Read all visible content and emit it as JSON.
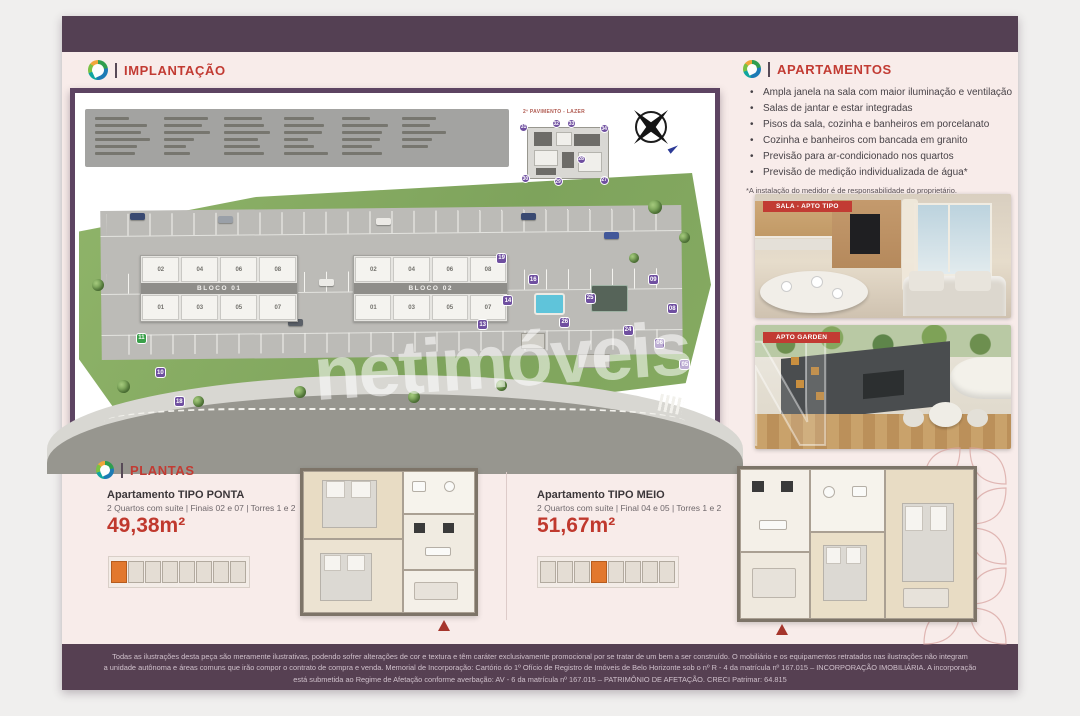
{
  "brand": {
    "watermark_text": "netimóveis",
    "watermark_initial": "N"
  },
  "implantacao": {
    "title": "IMPLANTAÇÃO",
    "inset_label": "2º PAVIMENTO - LAZER",
    "blocks": [
      {
        "name": "BLOCO 01",
        "top_units": [
          "02",
          "04",
          "06",
          "08"
        ],
        "bottom_units": [
          "01",
          "03",
          "05",
          "07"
        ]
      },
      {
        "name": "BLOCO 02",
        "top_units": [
          "02",
          "04",
          "06",
          "08"
        ],
        "bottom_units": [
          "01",
          "03",
          "05",
          "07"
        ]
      }
    ],
    "badges": [
      {
        "n": "11",
        "x": 9,
        "y": 60,
        "v": "green"
      },
      {
        "n": "10",
        "x": 12,
        "y": 73
      },
      {
        "n": "18",
        "x": 15,
        "y": 84
      },
      {
        "n": "19",
        "x": 66,
        "y": 30
      },
      {
        "n": "16",
        "x": 71,
        "y": 38
      },
      {
        "n": "14",
        "x": 67,
        "y": 46
      },
      {
        "n": "13",
        "x": 63,
        "y": 55
      },
      {
        "n": "26",
        "x": 76,
        "y": 54
      },
      {
        "n": "25",
        "x": 80,
        "y": 45
      },
      {
        "n": "24",
        "x": 86,
        "y": 57
      },
      {
        "n": "09",
        "x": 90,
        "y": 38
      },
      {
        "n": "08",
        "x": 93,
        "y": 49
      },
      {
        "n": "06",
        "x": 91,
        "y": 62
      },
      {
        "n": "05",
        "x": 95,
        "y": 70
      }
    ],
    "inset_badges": [
      {
        "n": "31",
        "x": 0,
        "y": 6
      },
      {
        "n": "32",
        "x": 34,
        "y": 0
      },
      {
        "n": "33",
        "x": 50,
        "y": 0
      },
      {
        "n": "34",
        "x": 84,
        "y": 8
      },
      {
        "n": "28",
        "x": 60,
        "y": 54
      },
      {
        "n": "30",
        "x": 2,
        "y": 84
      },
      {
        "n": "29",
        "x": 36,
        "y": 88
      },
      {
        "n": "27",
        "x": 84,
        "y": 86
      }
    ]
  },
  "apartamentos": {
    "title": "APARTAMENTOS",
    "bullets": [
      "Ampla janela na sala com maior iluminação e ventilação",
      "Salas de jantar e estar integradas",
      "Pisos da sala, cozinha e banheiros em porcelanato",
      "Cozinha e banheiros com bancada em granito",
      "Previsão para ar-condicionado nos quartos",
      "Previsão de medição individualizada de água*"
    ],
    "footnote": "*A instalação do medidor é de responsabilidade do proprietário.",
    "photos": [
      {
        "tag": "SALA - APTO TIPO"
      },
      {
        "tag": "APTO GARDEN"
      }
    ]
  },
  "plantas": {
    "title": "PLANTAS",
    "units": [
      {
        "name": "Apartamento TIPO PONTA",
        "specs": "2 Quartos com suíte | Finais 02 e 07 | Torres 1 e 2",
        "area": "49,38m²",
        "keyplan_highlight": 0
      },
      {
        "name": "Apartamento TIPO MEIO",
        "specs": "2 Quartos com suíte | Final 04 e 05 | Torres 1 e 2",
        "area": "51,67m²",
        "keyplan_highlight": 3
      }
    ]
  },
  "disclaimer": {
    "line1": "Todas as ilustrações desta peça são meramente ilustrativas, podendo sofrer alterações de cor e textura e têm caráter exclusivamente promocional por se tratar de um bem a ser construído. O mobiliário e os equipamentos retratados nas ilustrações não integram",
    "line2": "a unidade autônoma e áreas comuns que irão compor o contrato de compra e venda. Memorial de Incorporação: Cartório do 1º Ofício de Registro de Imóveis de Belo Horizonte sob o nº R - 4 da matrícula nº 167.015 – INCORPORAÇÃO IMOBILIÁRIA. A incorporação",
    "line3": "está submetida ao Regime de Afetação conforme averbação: AV - 6 da matrícula nº 167.015 – PATRIMÔNIO DE AFETAÇÃO. CRECI Patrimar: 64.815"
  }
}
